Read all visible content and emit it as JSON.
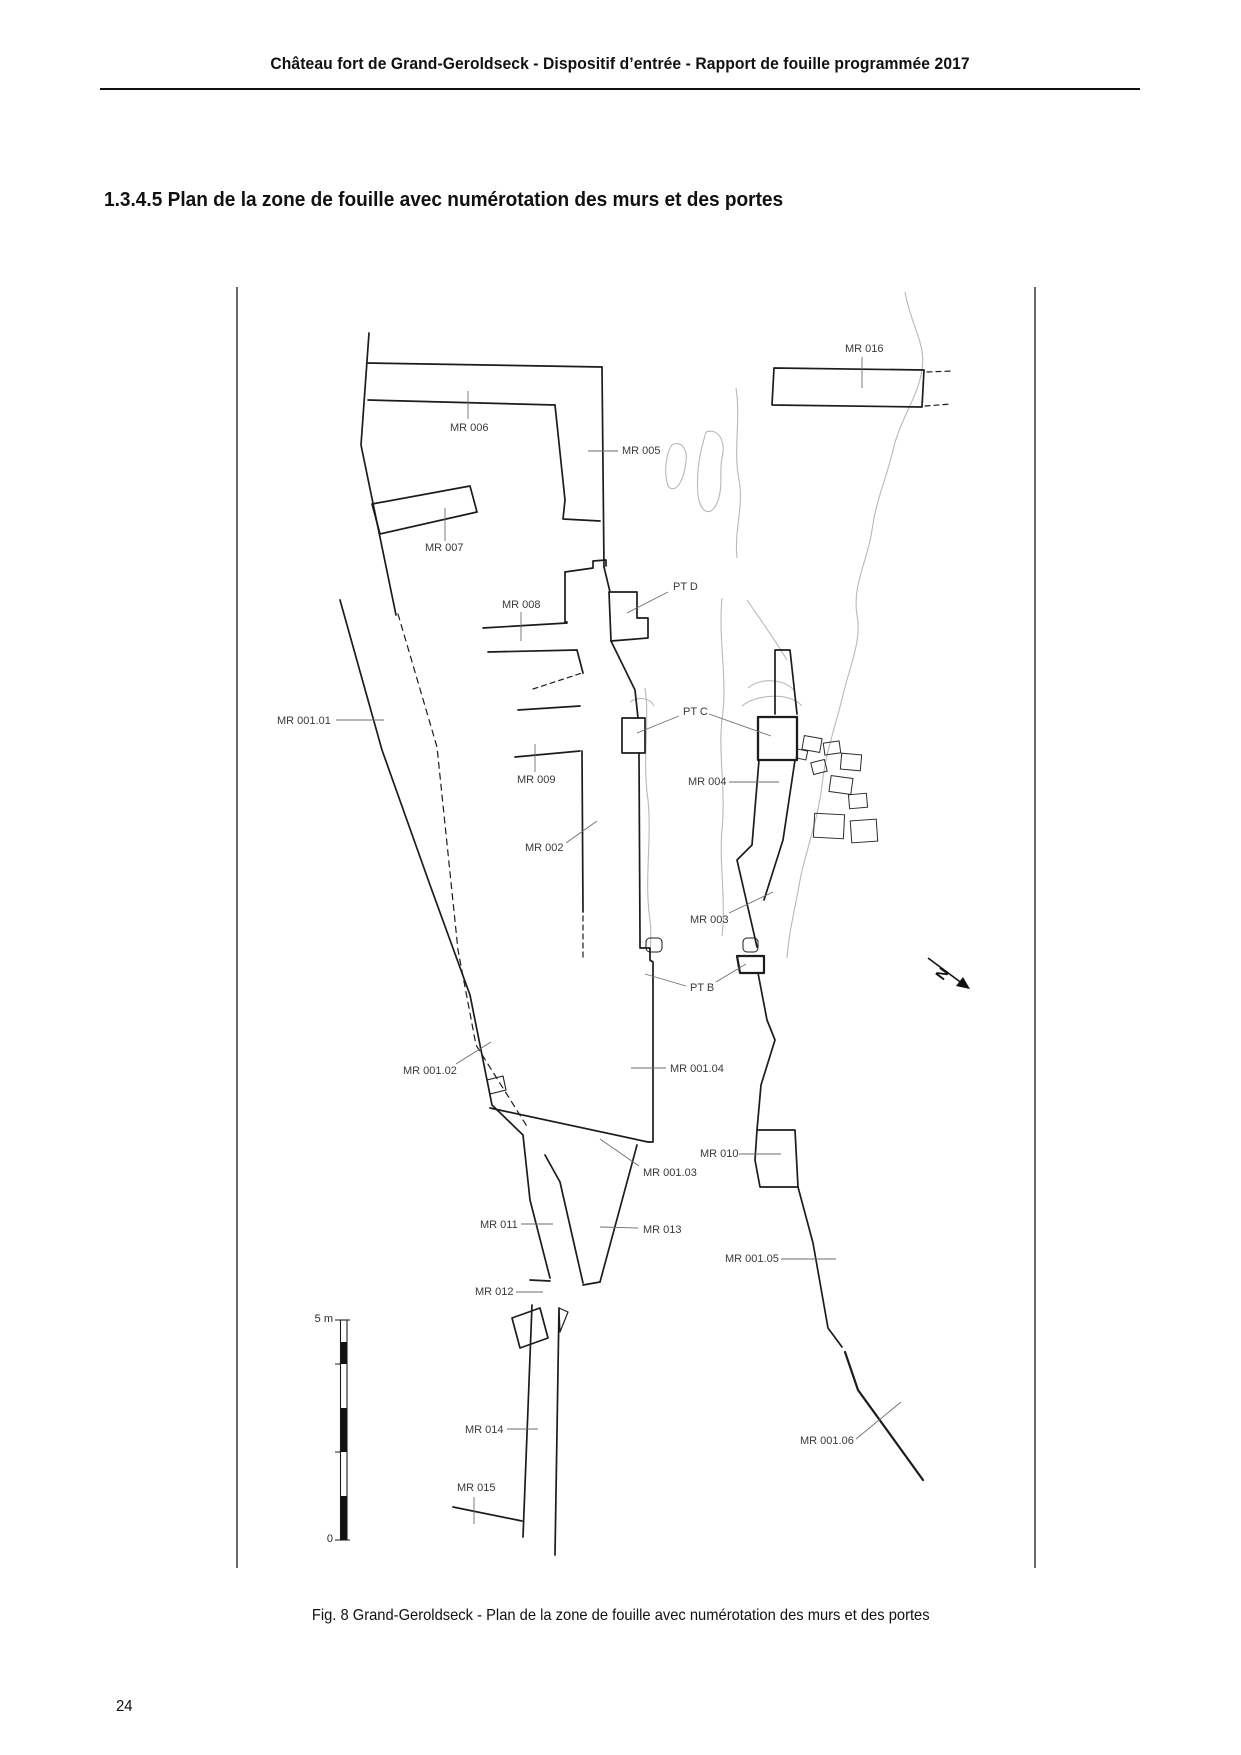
{
  "header": {
    "text": "Château fort de Grand-Geroldseck - Dispositif d’entrée - Rapport de fouille programmée 2017"
  },
  "section_title": "1.3.4.5 Plan de la zone de fouille avec numérotation des murs et des portes",
  "figure": {
    "caption": "Fig. 8 Grand-Geroldseck - Plan de la zone de fouille avec numérotation des murs et des portes",
    "north_label": "N",
    "scale": {
      "top_label": "5 m",
      "bottom_label": "0"
    },
    "labels": [
      {
        "id": "MR016",
        "text": "MR 016"
      },
      {
        "id": "MR006",
        "text": "MR 006"
      },
      {
        "id": "MR005",
        "text": "MR 005"
      },
      {
        "id": "MR007",
        "text": "MR 007"
      },
      {
        "id": "MR008",
        "text": "MR 008"
      },
      {
        "id": "PTD",
        "text": "PT D"
      },
      {
        "id": "MR00101",
        "text": "MR 001.01"
      },
      {
        "id": "PTC",
        "text": "PT C"
      },
      {
        "id": "MR009",
        "text": "MR 009"
      },
      {
        "id": "MR004",
        "text": "MR 004"
      },
      {
        "id": "MR002",
        "text": "MR 002"
      },
      {
        "id": "MR003",
        "text": "MR 003"
      },
      {
        "id": "PTB",
        "text": "PT B"
      },
      {
        "id": "MR00102",
        "text": "MR 001.02"
      },
      {
        "id": "MR00104",
        "text": "MR 001.04"
      },
      {
        "id": "MR010",
        "text": "MR 010"
      },
      {
        "id": "MR00103",
        "text": "MR 001.03"
      },
      {
        "id": "MR011",
        "text": "MR 011"
      },
      {
        "id": "MR013",
        "text": "MR 013"
      },
      {
        "id": "MR012",
        "text": "MR 012"
      },
      {
        "id": "MR00105",
        "text": "MR 001.05"
      },
      {
        "id": "MR014",
        "text": "MR 014"
      },
      {
        "id": "MR015",
        "text": "MR 015"
      },
      {
        "id": "MR00106",
        "text": "MR 001.06"
      }
    ]
  },
  "page_number": "24",
  "colors": {
    "ink": "#1c1c1c",
    "label": "#3a3a3a",
    "leader": "#6e6e6e",
    "terrain": "#b8b8b8"
  }
}
